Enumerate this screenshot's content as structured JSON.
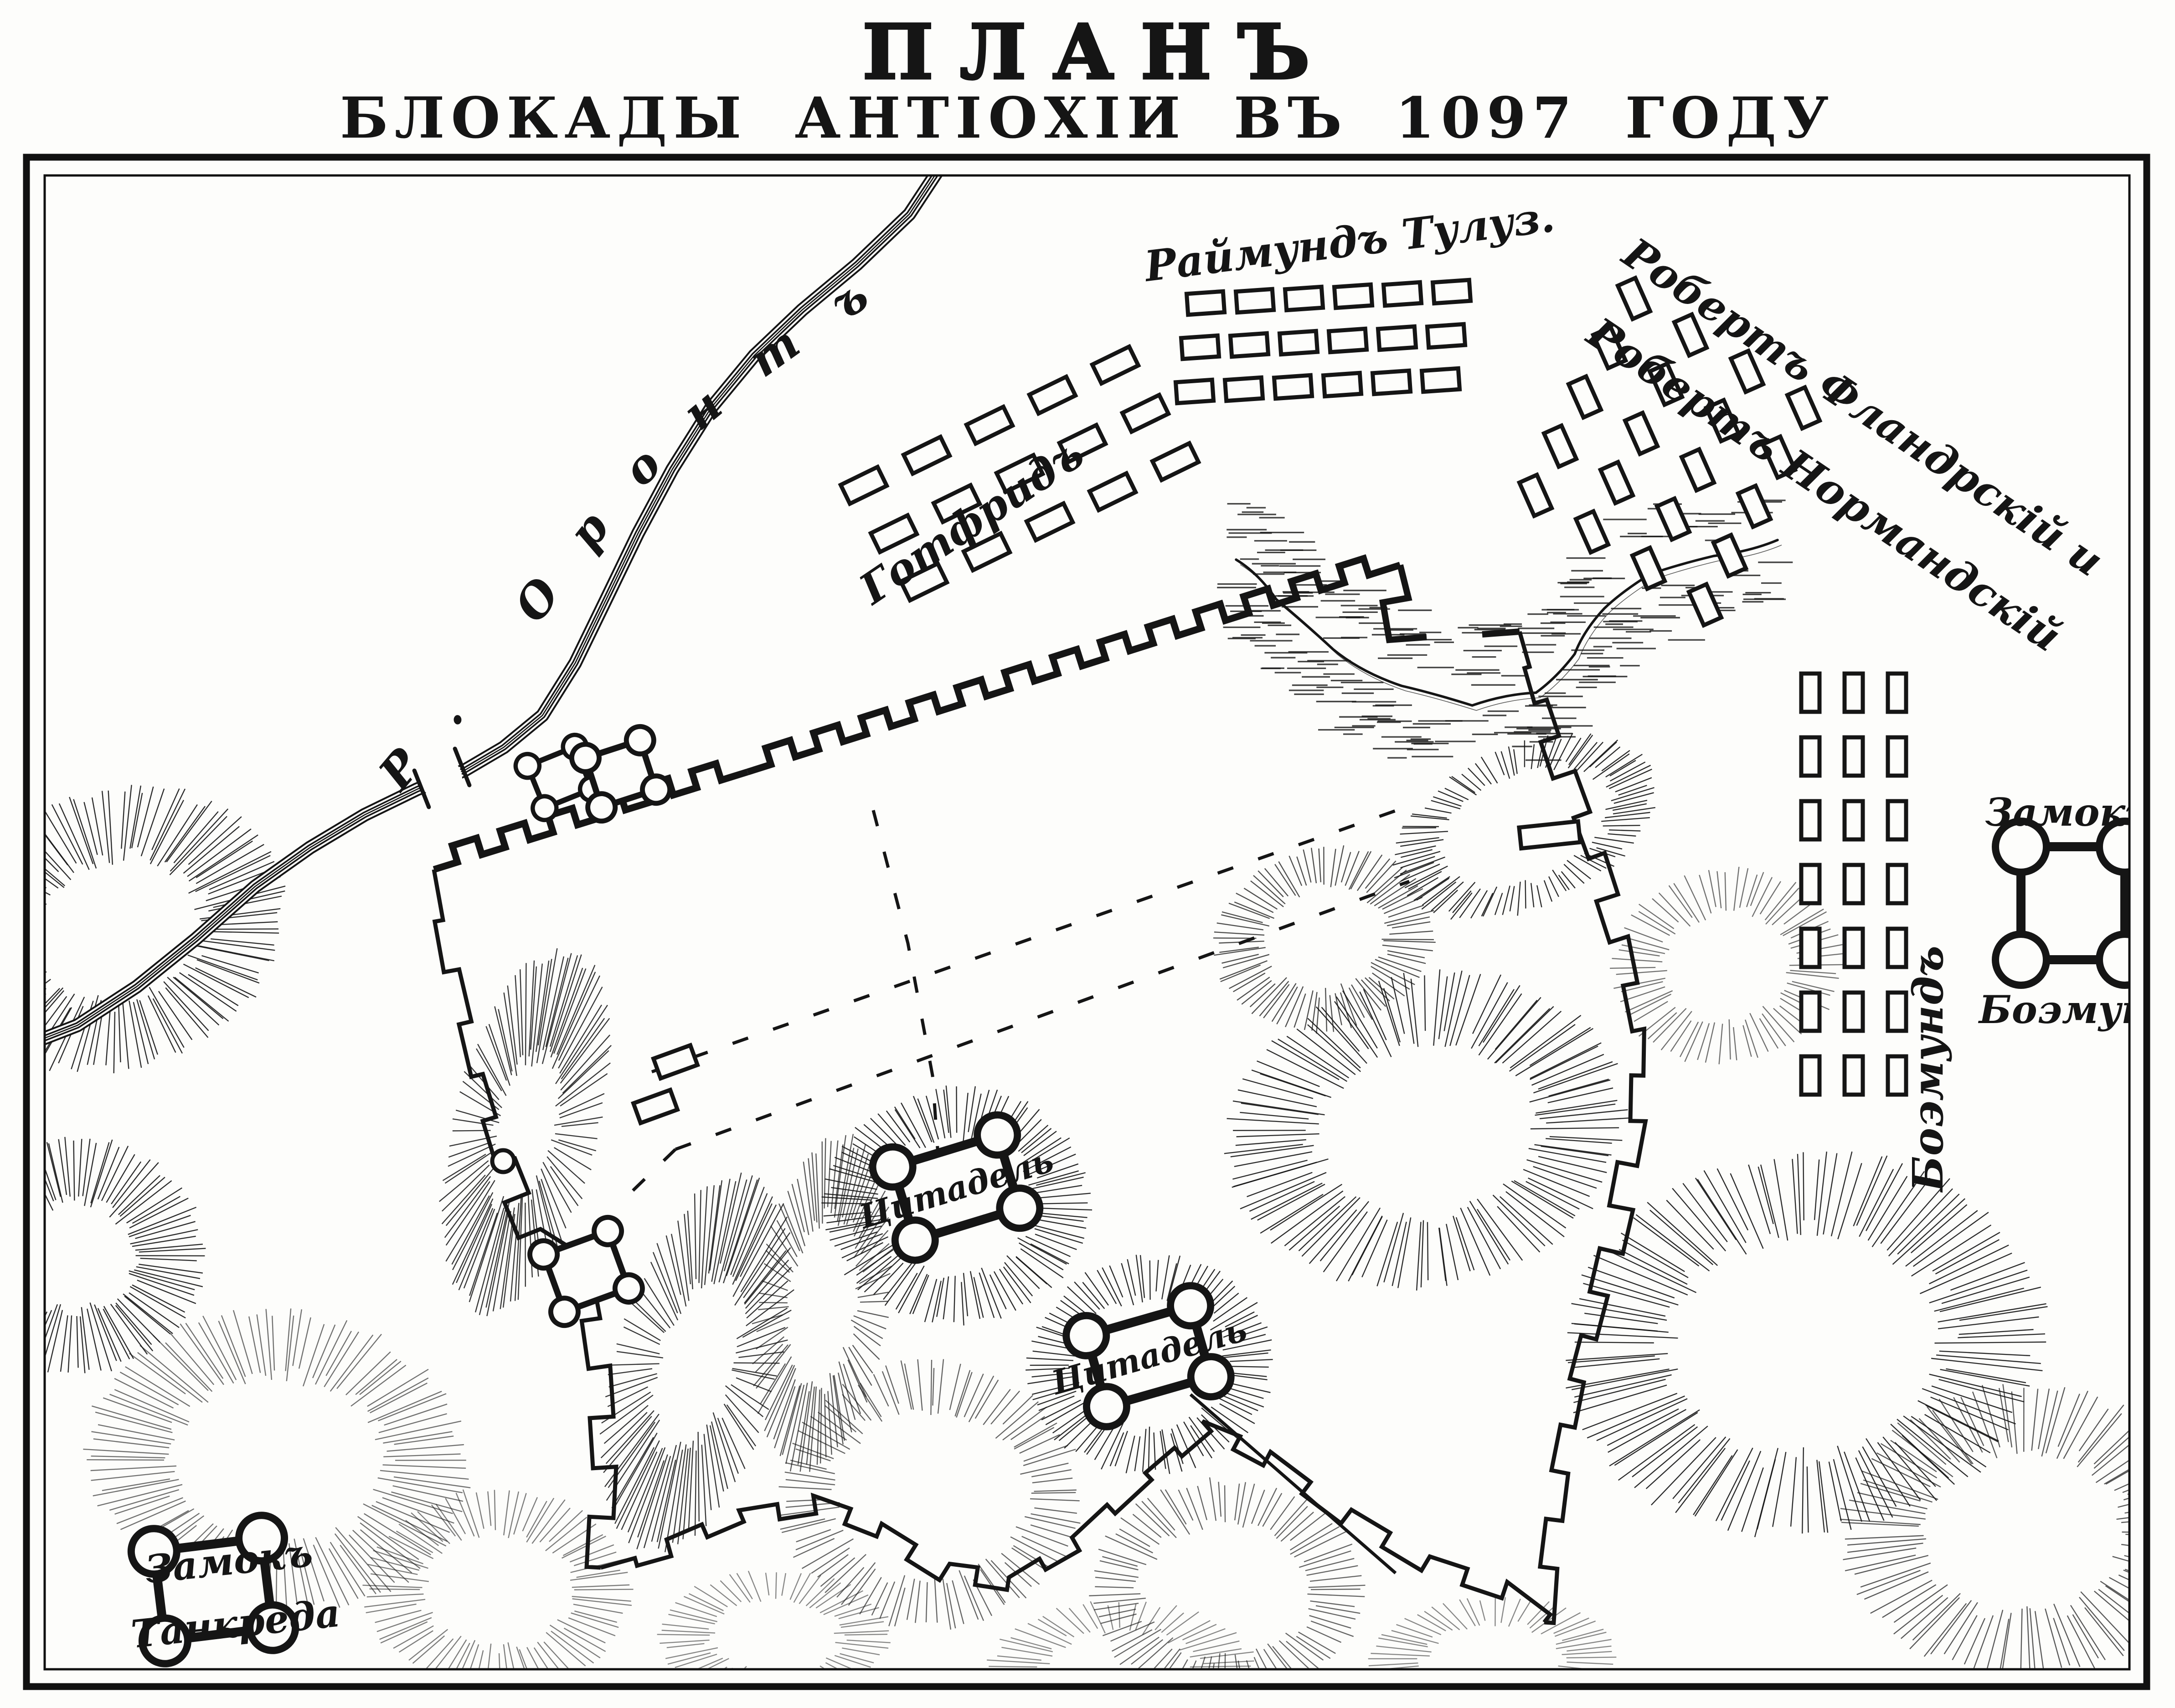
{
  "title": {
    "line1": "ПЛАНЪ",
    "line2": "БЛОКАДЫ АНТІОХІИ ВЪ 1097 ГОДУ"
  },
  "colors": {
    "ink": "#151515",
    "paper": "#fdfdfb"
  },
  "river": {
    "label": "Р. Оронтъ"
  },
  "labels": {
    "raymond": "Раймундъ Тулуз.",
    "godfrey": "Готфридъ",
    "robert_flanders": "Робертъ Фландрскій и",
    "robert_normandy": "Робертъ Нормандскій",
    "bohemond_camp": "Боэмундъ",
    "bohemond_castle_top": "Замокъ",
    "bohemond_castle_bottom": "Боэмунда",
    "tancred_castle_top": "Замокъ",
    "tancred_castle_bottom": "Танкреда",
    "citadel_north": "Цитадель",
    "citadel_south": "Цитадель"
  },
  "camps": [
    {
      "id": "raymond",
      "leader_label": "raymond",
      "rows": 3,
      "cols": 6,
      "origin": [
        2645,
        665
      ],
      "col_step": [
        108,
        -5
      ],
      "row_step": [
        -12,
        97
      ],
      "tent": [
        80,
        46
      ],
      "tent_rot": -4
    },
    {
      "id": "godfrey",
      "leader_label": "godfrey",
      "rows": 3,
      "cols": 5,
      "origin": [
        1895,
        1065
      ],
      "col_step": [
        138,
        -66
      ],
      "row_step": [
        66,
        106
      ],
      "tent": [
        90,
        46
      ],
      "tent_rot": -26
    },
    {
      "id": "robert",
      "leader_label": "robert_flanders",
      "rows": 5,
      "cols": 4,
      "origin": [
        3585,
        655
      ],
      "col_step": [
        124,
        80
      ],
      "row_step": [
        -54,
        108
      ],
      "tent": [
        42,
        80
      ],
      "tent_rot": -24
    },
    {
      "id": "bohemond",
      "leader_label": "bohemond_camp",
      "rows": 7,
      "cols": 3,
      "origin": [
        3972,
        1520
      ],
      "col_step": [
        95,
        0
      ],
      "row_step": [
        0,
        140
      ],
      "tent": [
        40,
        84
      ],
      "tent_rot": 0
    }
  ],
  "forts": [
    {
      "id": "bridge-fort-west",
      "c": [
        1228,
        1706
      ],
      "size": [
        112,
        100
      ],
      "rot": -22,
      "tower": 26
    },
    {
      "id": "bridge-fort-east",
      "c": [
        1362,
        1698
      ],
      "size": [
        126,
        114
      ],
      "rot": -18,
      "tower": 30
    },
    {
      "id": "west-wall-fort",
      "c": [
        1286,
        2790
      ],
      "size": [
        150,
        134
      ],
      "rot": -20,
      "tower": 30
    },
    {
      "id": "citadel-north-fort",
      "c": [
        2098,
        2606
      ],
      "size": [
        240,
        168
      ],
      "rot": -17,
      "tower": 44
    },
    {
      "id": "citadel-south-fort",
      "c": [
        2520,
        2976
      ],
      "size": [
        238,
        162
      ],
      "rot": -16,
      "tower": 44
    },
    {
      "id": "tancred-castle",
      "c": [
        468,
        3488
      ],
      "size": [
        238,
        198
      ],
      "rot": -7,
      "tower": 50
    },
    {
      "id": "bohemond-castle",
      "c": [
        4548,
        1982
      ],
      "size": [
        228,
        248
      ],
      "rot": 0,
      "tower": 56
    }
  ],
  "buildings": [
    {
      "id": "plateau-building",
      "c": [
        3400,
        1832
      ],
      "size": [
        130,
        46
      ],
      "rot": -6
    },
    {
      "id": "city-building-1",
      "c": [
        1482,
        2330
      ],
      "size": [
        86,
        46
      ],
      "rot": -20
    },
    {
      "id": "city-building-2",
      "c": [
        1438,
        2428
      ],
      "size": [
        86,
        46
      ],
      "rot": -20
    }
  ]
}
